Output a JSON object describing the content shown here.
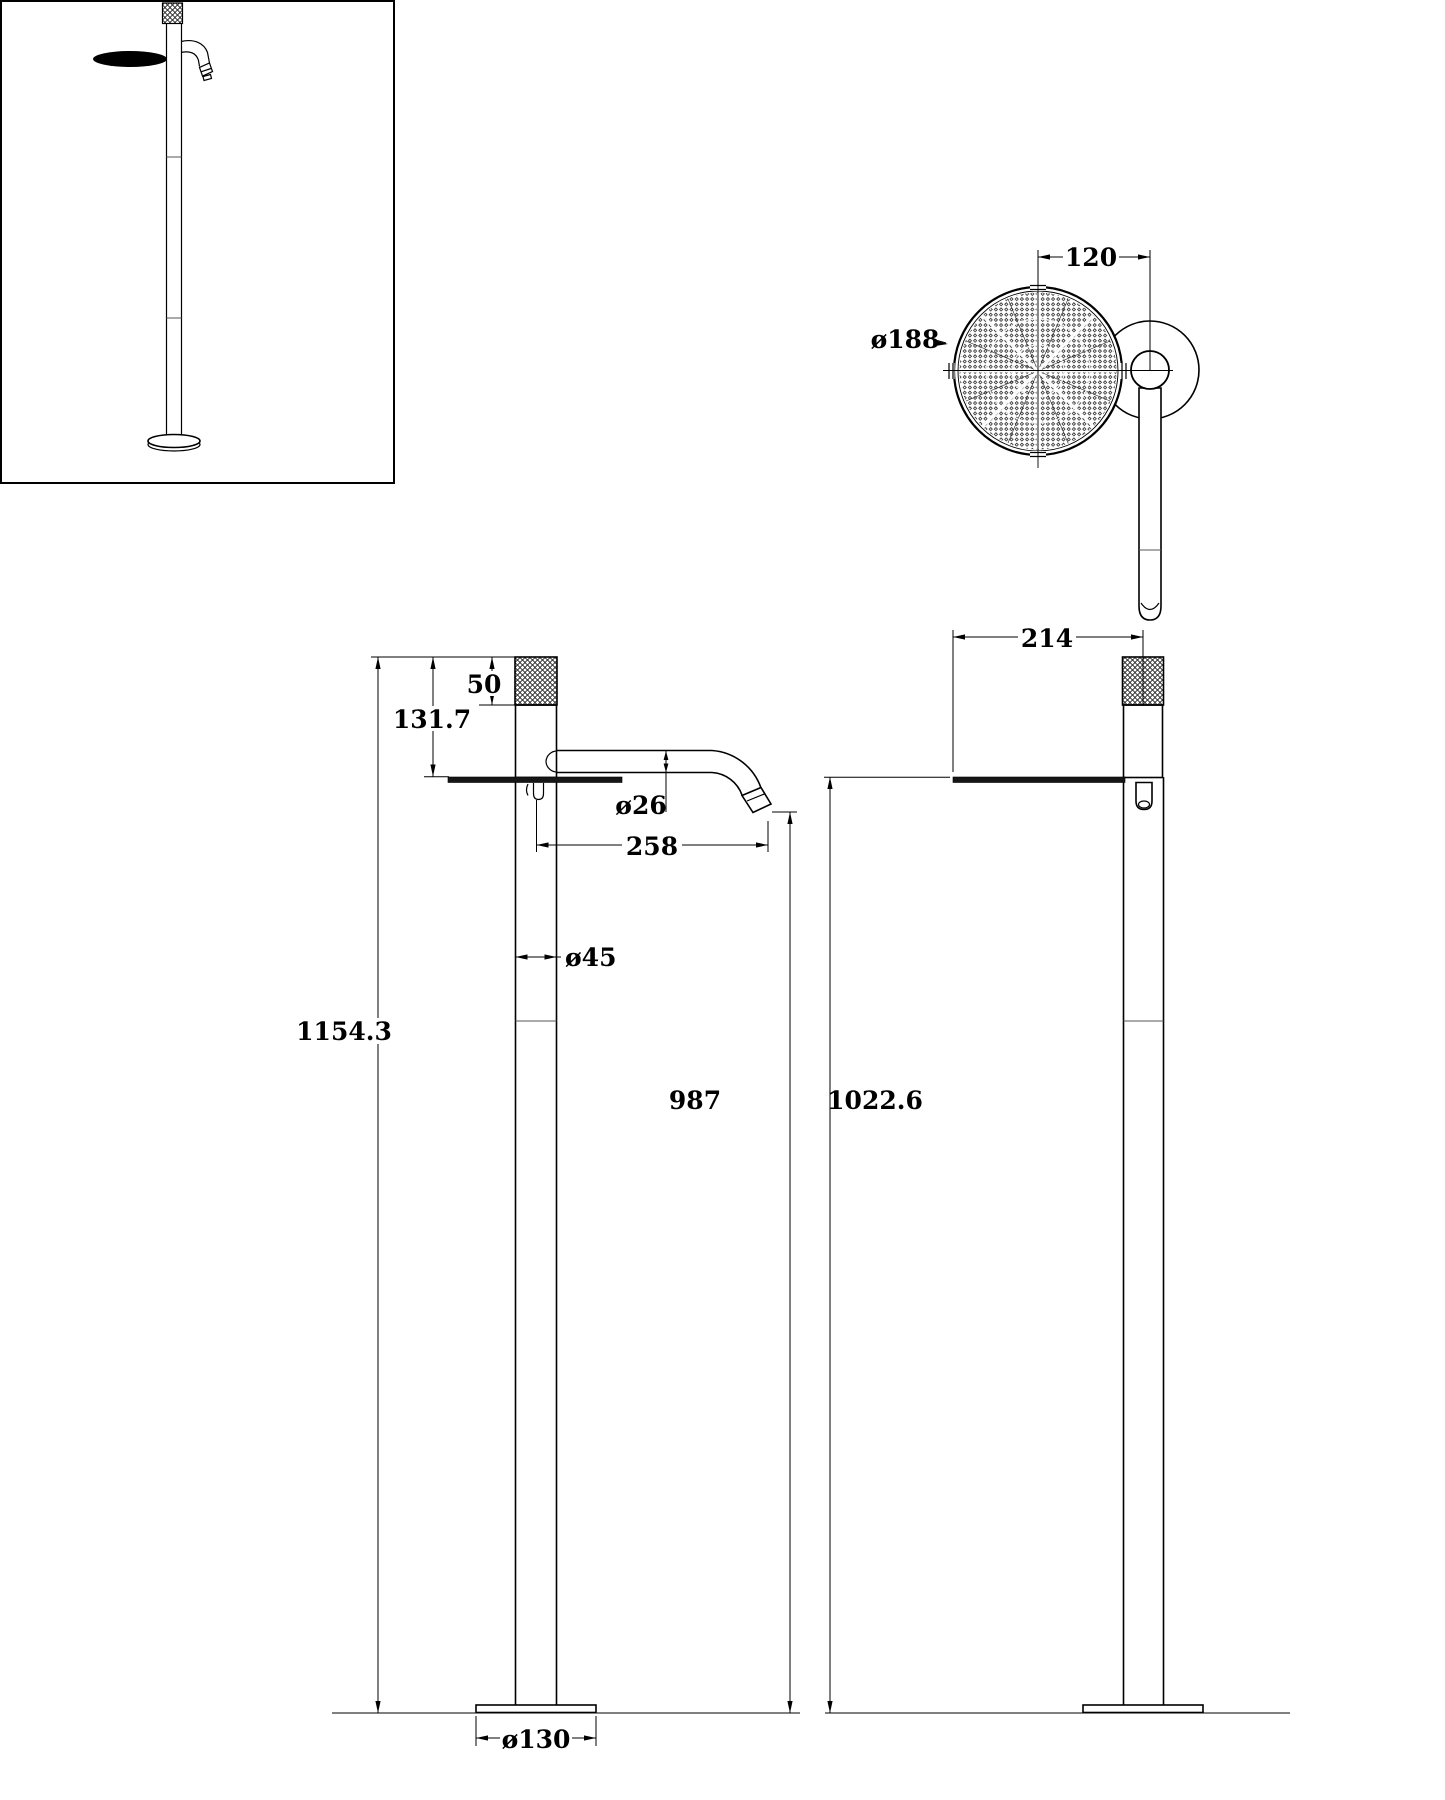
{
  "colors": {
    "line": "#000000",
    "background": "#ffffff",
    "tray_fill": "#161616"
  },
  "dimensions": {
    "top_view": {
      "handle_center_offset": "120",
      "tray_diameter": "ø188"
    },
    "front_view": {
      "handle_length": "50",
      "upper_section_height": "131.7",
      "spout_tube_diameter": "ø26",
      "spout_reach": "258",
      "column_diameter": "ø45",
      "overall_height": "1154.3",
      "spout_outlet_height": "987",
      "base_diameter": "ø130"
    },
    "side_view": {
      "overall_depth": "214",
      "tray_top_height": "1022.6"
    }
  }
}
